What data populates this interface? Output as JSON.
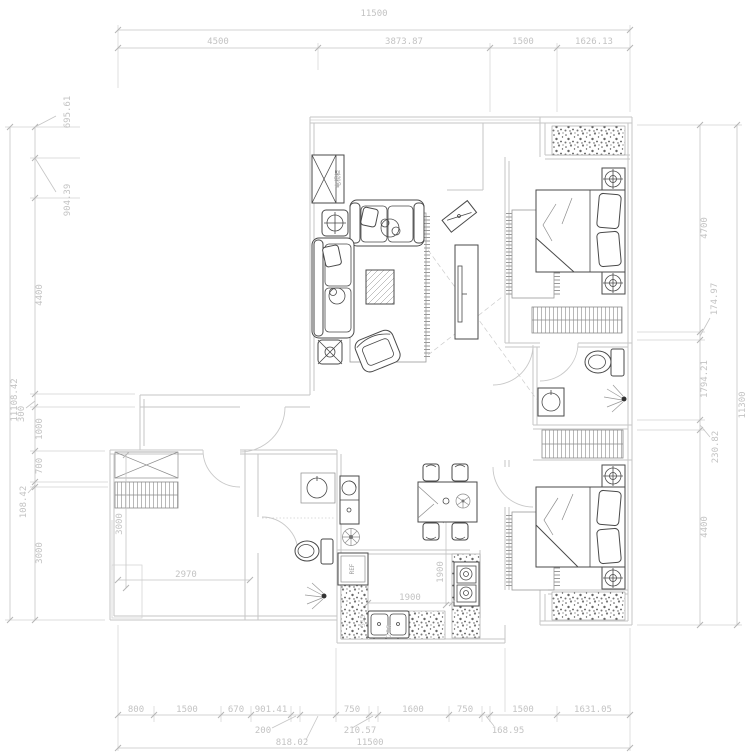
{
  "drawing": {
    "type": "apartment-floor-plan",
    "units": "mm"
  },
  "dims": {
    "top": {
      "total": "11500",
      "segments": [
        "4500",
        "3873.87",
        "1500",
        "1626.13"
      ]
    },
    "bottom": {
      "total": "11500",
      "segments": [
        "800",
        "1500",
        "670",
        "901.41",
        "200",
        "818.02",
        "750",
        "210.57",
        "1600",
        "750",
        "168.95",
        "1500",
        "1631.05"
      ]
    },
    "left": {
      "total": "11108.42",
      "segments": [
        "695.61",
        "904.39",
        "4400",
        "300",
        "1000",
        "700",
        "108.42",
        "3000"
      ]
    },
    "right": {
      "total": "11300",
      "segments": [
        "4700",
        "174.97",
        "1794.21",
        "230.82",
        "4400"
      ]
    }
  },
  "interior_dims": {
    "bedroom_width": "2970",
    "bedroom_depth": "3000",
    "kitchen_counter_width": "1900",
    "kitchen_counter_depth": "1900",
    "sink_width": "515",
    "sink_offset": "206"
  },
  "labels": {
    "fridge": "REF",
    "tv_cabinet": "电视柜"
  },
  "colors": {
    "dimension": "#c5c5c5",
    "wall": "#c6c6c6",
    "furniture": "#4a4a4a"
  }
}
